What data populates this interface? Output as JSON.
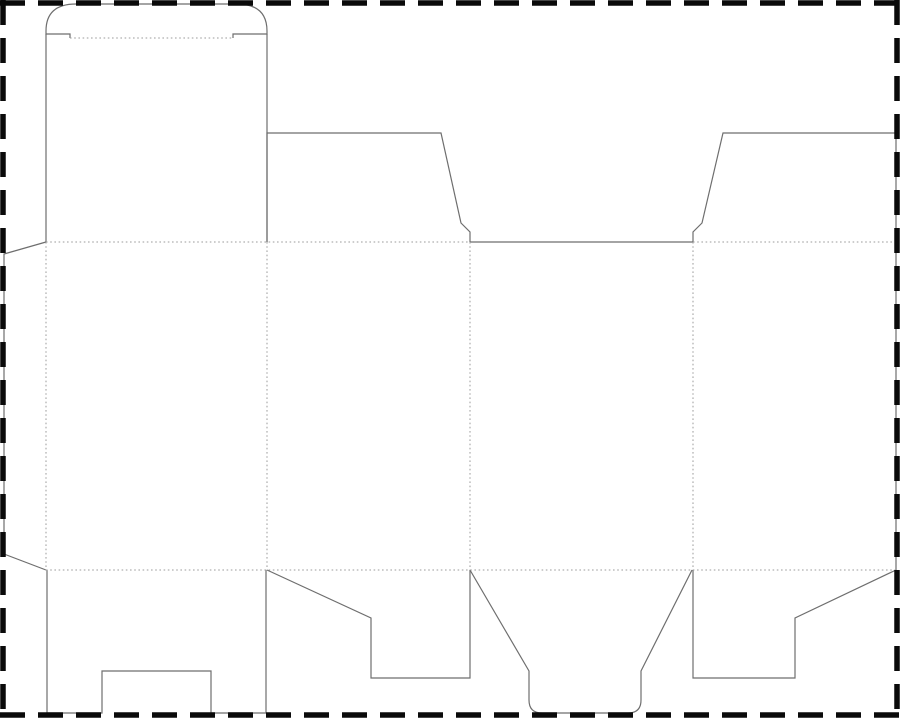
{
  "canvas": {
    "width": 900,
    "height": 718,
    "background_color": "#ffffff"
  },
  "line_styles": {
    "cut": {
      "color": "#6e6e6e",
      "width": 1.2,
      "dash": ""
    },
    "fold": {
      "color": "#9b9b9b",
      "width": 1,
      "dash": "1.6 2.6"
    },
    "frame": {
      "color": "#0a0a0a",
      "width": 5.5,
      "dash": "25 13"
    }
  },
  "dieline": {
    "type": "folding-carton-dieline",
    "cut_paths": [
      {
        "name": "top-tuck-lid",
        "d": "M 70 38 L 70 34 L 46 34 L 46 31 Q 46 4 76 4 L 237 4 Q 267 4 267 31 L 267 34 L 233 34 L 233 38"
      },
      {
        "name": "panel-1-left-edge",
        "d": "M 46 34 L 46 242"
      },
      {
        "name": "panel-1-right-edge",
        "d": "M 267 34 L 267 242"
      },
      {
        "name": "panel-2-top-flap",
        "d": "M 267 242 L 267 133 L 441 133 L 461 223 L 470 232 L 470 242"
      },
      {
        "name": "panel-3-top-edge",
        "d": "M 470 242 L 693 242"
      },
      {
        "name": "panel-4-top-flap",
        "d": "M 693 242 L 693 232 L 702 223 L 723 133 L 896 133"
      },
      {
        "name": "panel-4-right-edge",
        "d": "M 896 133 L 896 570"
      },
      {
        "name": "glue-flap",
        "d": "M 46 242 L 4 254 L 4 554 L 46 570"
      },
      {
        "name": "panel-1-bottom-flap",
        "d": "M 47 570 L 47 713 L 102 713 L 102 671 L 211 671 L 211 713 L 266 713 L 266 570"
      },
      {
        "name": "panel-2-bottom-flap",
        "d": "M 267 570 L 371 618 L 371 678 L 470 678 L 470 570"
      },
      {
        "name": "panel-3-bottom-flap",
        "d": "M 470 570 L 529 671 L 529 700 Q 529 713 542 713 L 628 713 Q 641 713 641 700 L 641 671 L 692 570"
      },
      {
        "name": "panel-4-bottom-flap",
        "d": "M 693 570 L 693 678 L 795 678 L 795 618 L 896 570"
      }
    ],
    "fold_lines": [
      {
        "name": "tuck-lid-fold",
        "d": "M 70 38 L 233 38"
      },
      {
        "name": "top-fold-left",
        "d": "M 46 242 L 470 242"
      },
      {
        "name": "top-fold-right",
        "d": "M 693 242 L 896 242"
      },
      {
        "name": "bottom-fold",
        "d": "M 46 570 L 896 570"
      },
      {
        "name": "glue-flap-fold",
        "d": "M 46 242 L 46 570"
      },
      {
        "name": "fold-panel-1-2",
        "d": "M 267 242 L 267 570"
      },
      {
        "name": "fold-panel-2-3",
        "d": "M 470 242 L 470 570"
      },
      {
        "name": "fold-panel-3-4",
        "d": "M 693 242 L 693 570"
      }
    ],
    "frame_lines": [
      {
        "name": "frame-top",
        "d": "M 0 3 L 900 3"
      },
      {
        "name": "frame-bottom",
        "d": "M 0 715 L 900 715"
      },
      {
        "name": "frame-left",
        "d": "M 3 0 L 3 718"
      },
      {
        "name": "frame-right",
        "d": "M 897 0 L 897 718"
      }
    ]
  }
}
